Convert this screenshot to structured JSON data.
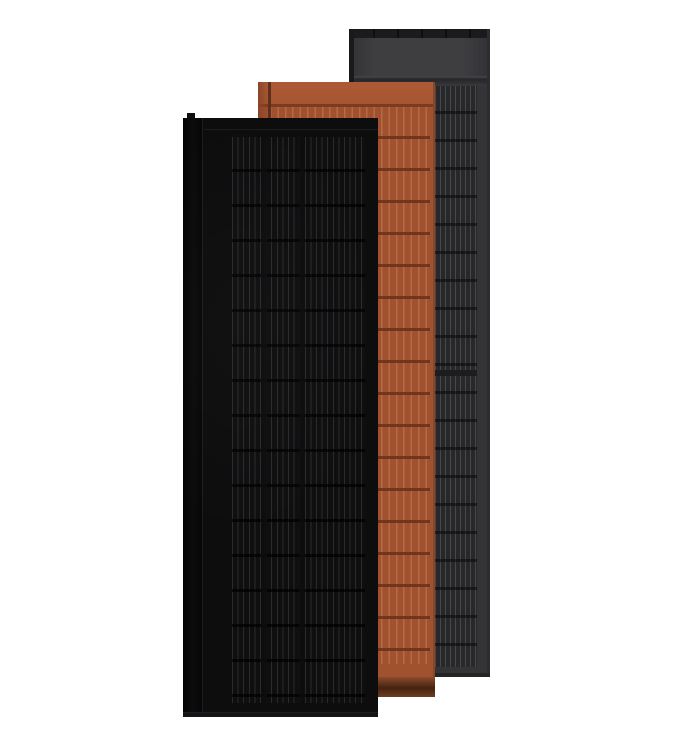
{
  "scene": {
    "description": "3D product render of three overlapping vertical roof-integrated solar panels standing upright on a white background: a matte black panel in front, a terracotta orange panel in the middle, and a dark slate gray panel behind",
    "background_color": "#ffffff",
    "panels": [
      {
        "id": "panel-slate",
        "name": "Slate gray solar panel",
        "position": "back",
        "colors": {
          "frame": "#1b1b1d",
          "header": "#3e3e41",
          "cellBase": "#28282b",
          "cellLine": "#48484b",
          "rowGap": "#1d1d1f",
          "edge": "#19191b"
        }
      },
      {
        "id": "panel-terracotta",
        "name": "Terracotta solar panel",
        "position": "middle",
        "colors": {
          "header": "#a5552f",
          "cellBase": "#9f5130",
          "cellLine": "#b96a42",
          "rowGap": "#7c3a20",
          "sideEdge": "#8a4628",
          "footerLight": "#8a4c2e",
          "footerDark": "#45220f"
        }
      },
      {
        "id": "panel-black",
        "name": "Matte black solar panel",
        "position": "front",
        "colors": {
          "face": "#0d0d0e",
          "frameEdge": "#040405",
          "edgeHighlight": "#1f1f22",
          "cellBase": "#0f0f10",
          "cellLine": "#2b2b2e",
          "rowGap": "#050506"
        }
      }
    ]
  }
}
